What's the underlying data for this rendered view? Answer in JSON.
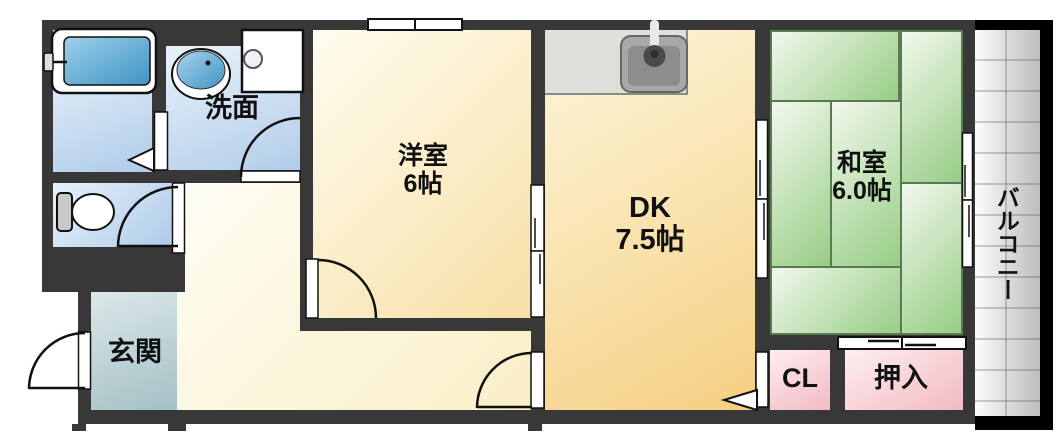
{
  "floorplan": {
    "rooms": {
      "senmen_label": "洗面",
      "genkan_label": "玄関",
      "yoshitsu_name": "洋室",
      "yoshitsu_size": "6帖",
      "dk_name": "DK",
      "dk_size": "7.5帖",
      "washitsu_name": "和室",
      "washitsu_size": "6.0帖",
      "cl_label": "CL",
      "oshiire_label": "押入",
      "balcony_label": "バルコニー"
    },
    "colors": {
      "wall": "#383838",
      "western_room": "#f7dfa5",
      "dining_kitchen": "#f5cf82",
      "tatami_green": "#97cd85",
      "wet_area_blue": "#aecbe9",
      "entrance_teal": "#a3c0c6",
      "closet_pink": "#f2bac2",
      "balcony_gray": "#bdbdbd"
    }
  }
}
